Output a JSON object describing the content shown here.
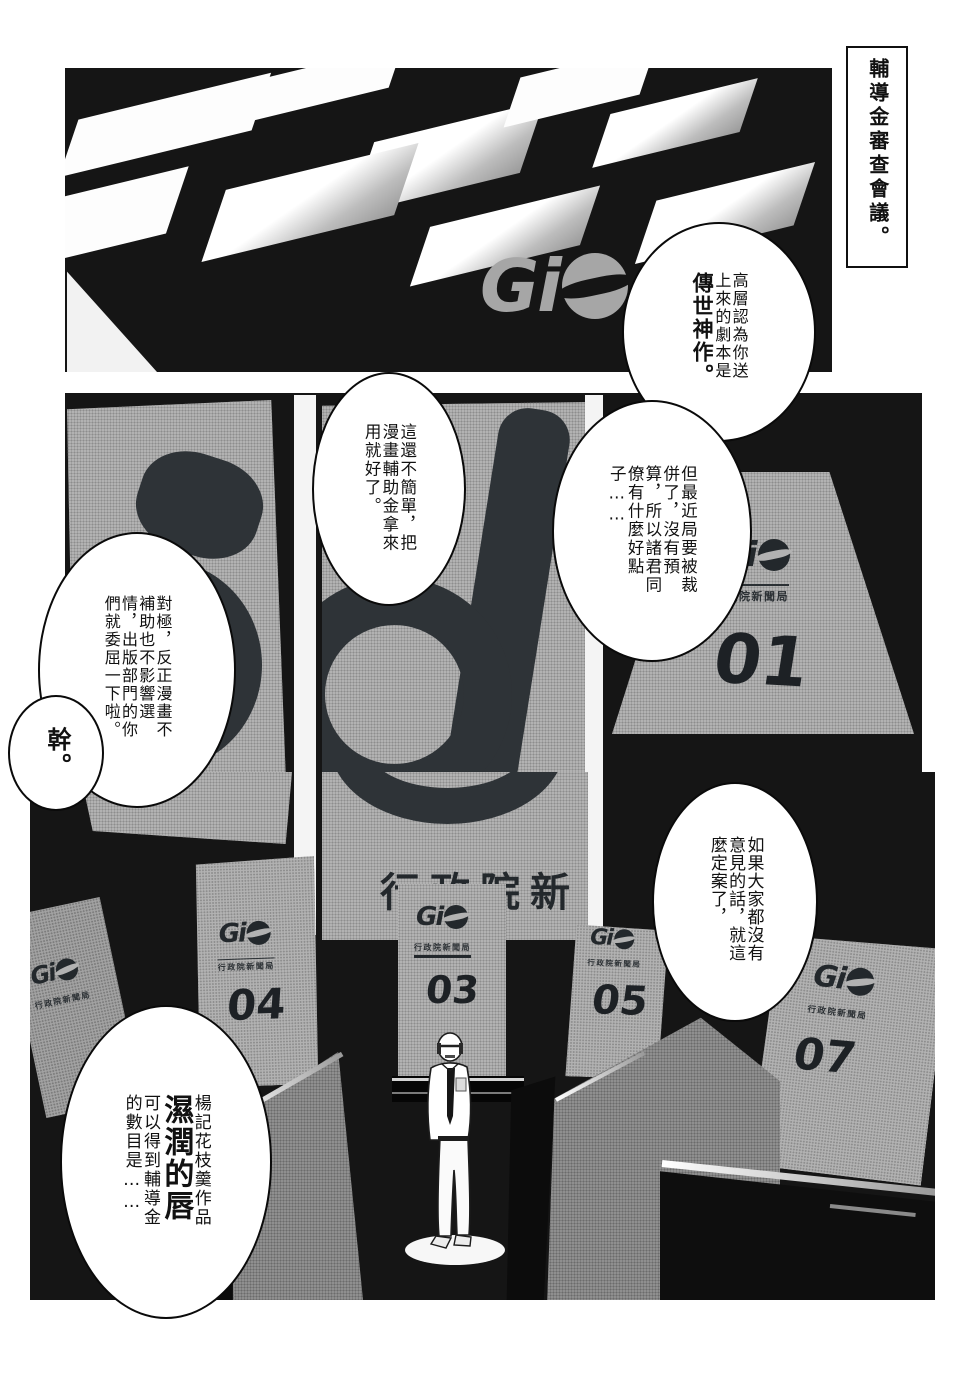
{
  "caption": "輔導金審查會議。",
  "logos": {
    "gio_letters": "Gi",
    "agency_full": "行政院新聞局",
    "agency_partial": "行政院新"
  },
  "podiums": {
    "p01": "01",
    "p03": "03",
    "p04": "04",
    "p05": "05",
    "p07": "07"
  },
  "bubbles": {
    "b1_normal": "高層認為你送上來的劇本是",
    "b1_bold": "傳世神作。",
    "b2": "這還不簡單，把漫畫輔助金拿來用就好了。",
    "b3": "但最近局要被裁併了，沒有預算，所以諸君同僚有什麼好點子……",
    "b4": "對極，反正漫畫不補助也不影響選情，出版部門的你們就委屈一下啦。",
    "b5": "幹。",
    "b6": "如果大家都沒有意見的話，就這麼定案了，",
    "b7_top": "楊記花枝羹作品",
    "b7_bold": "濕潤的唇",
    "b7_rest": "可以得到輔導金的數目是……"
  }
}
